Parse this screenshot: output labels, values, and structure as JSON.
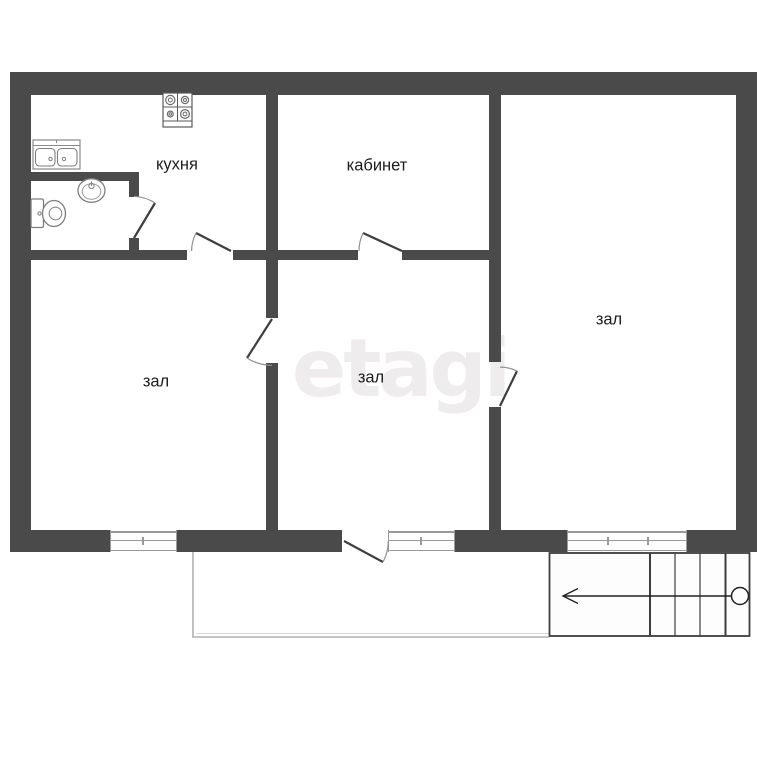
{
  "plan_title": "apartment-floor-plan",
  "watermark": {
    "text": "etagi"
  },
  "rooms": {
    "kitchen": {
      "label": "кухня"
    },
    "office": {
      "label": "кабинет"
    },
    "hall_right": {
      "label": "зал"
    },
    "hall_left": {
      "label": "зал"
    },
    "hall_middle": {
      "label": "зал"
    }
  },
  "fixtures": [
    "stove-icon",
    "kitchen-sink-icon",
    "washbasin-icon",
    "toilet-icon",
    "staircase",
    "stairs-direction-arrow",
    "porch-outline"
  ],
  "doors": [
    "door-bathroom",
    "door-kitchen",
    "door-office",
    "door-hall-left",
    "door-hall-right",
    "door-entrance"
  ],
  "windows": [
    "window-hall-left",
    "window-hall-middle",
    "window-hall-right"
  ],
  "colors": {
    "wall": "#4a4a4a",
    "label": "#1d1d1d",
    "watermark": "#eeecec",
    "window_line": "#9a9a9a",
    "porch_line": "#b0b0b0",
    "stairs_line": "#3d3d3d",
    "fixture_line": "#7d7d7d"
  }
}
